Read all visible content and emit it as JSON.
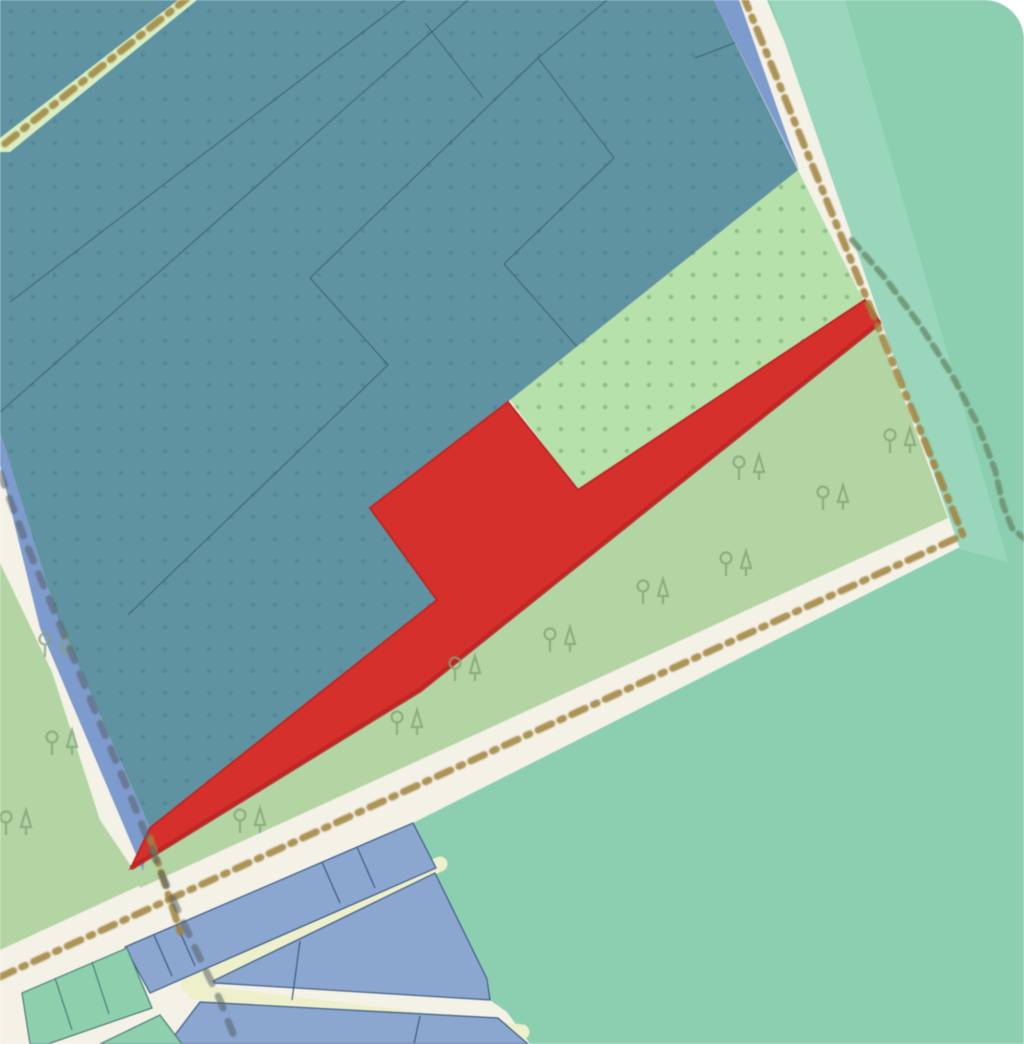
{
  "map": {
    "name": "map-view",
    "canvas": {
      "width": 1024,
      "height": 1044
    },
    "colors": {
      "base_road_cream": "#f4f1e7",
      "pale_yellow_road": "#edf0cb",
      "teal_industrial": "#5f93a2",
      "teal_dot": "#47808f",
      "mint_background": "#8ccfb0",
      "mint_band": "#99d6bc",
      "green_scrub_dotted": "#b6e1ab",
      "green_scrub_dot": "#84b97a",
      "green_wood": "#b3d5a3",
      "path_strip_green": "#daeec2",
      "blue_strip": "#7d9bcc",
      "blue_parcel": "#8ba6cf",
      "blue_parcel_outline": "#3e5a80",
      "mint_parcel": "#8ecfae",
      "mint_parcel_outline": "#497a74",
      "selected_red": "#d6302d",
      "selected_red_edge": "#bd2723",
      "boundary_brown": "#a0823c",
      "boundary_gray": "#555e66",
      "boundary_green": "#6b9170",
      "parcel_line_teal_area": "#2f566b",
      "tree_glyph": "#85a37b",
      "corner_white": "#ffffff"
    },
    "patterns": [
      {
        "id": "teal-dots",
        "size": 22,
        "r": 2.3,
        "color": "#47808f",
        "opacity": 0.55
      },
      {
        "id": "green-dots",
        "size": 22,
        "r": 2.3,
        "color": "#84b97a",
        "opacity": 0.8
      }
    ],
    "regions": [
      {
        "name": "mint-background-area",
        "fill": "#8ccfb0",
        "points": [
          [
            767,
            0
          ],
          [
            1024,
            0
          ],
          [
            1024,
            1044
          ],
          [
            530,
            1044
          ],
          [
            507,
            1012
          ],
          [
            490,
            1000
          ],
          [
            488,
            980
          ],
          [
            432,
            868
          ],
          [
            413,
            823
          ],
          [
            962,
            546
          ],
          [
            985,
            518
          ]
        ]
      },
      {
        "name": "mint-roadside-band",
        "fill": "#99d6bc",
        "points": [
          [
            770,
            0
          ],
          [
            845,
            0
          ],
          [
            1008,
            562
          ],
          [
            960,
            549
          ]
        ]
      },
      {
        "name": "wood-area-left",
        "fill": "#b3d5a3",
        "points": [
          [
            0,
            563
          ],
          [
            52,
            672
          ],
          [
            100,
            820
          ],
          [
            143,
            884
          ],
          [
            0,
            950
          ]
        ]
      },
      {
        "name": "wood-wedge-southeast",
        "fill": "#b3d5a3",
        "points": [
          [
            870,
            308
          ],
          [
            948,
            518
          ],
          [
            140,
            888
          ],
          [
            131,
            868
          ],
          [
            420,
            690
          ],
          [
            880,
            324
          ]
        ]
      },
      {
        "name": "scrub-dotted-wedge",
        "fill": "#b6e1ab",
        "pattern": "green-dots",
        "points": [
          [
            798,
            170
          ],
          [
            863,
            300
          ],
          [
            578,
            490
          ],
          [
            510,
            400
          ]
        ]
      },
      {
        "name": "industrial-teal-area",
        "fill": "#5f93a2",
        "pattern": "teal-dots",
        "points": [
          [
            0,
            0
          ],
          [
            714,
            0
          ],
          [
            798,
            170
          ],
          [
            510,
            400
          ],
          [
            370,
            508
          ],
          [
            437,
            600
          ],
          [
            150,
            828
          ],
          [
            58,
            620
          ],
          [
            0,
            432
          ]
        ]
      },
      {
        "name": "path-strip-topleft",
        "fill": "#daeec2",
        "points": [
          [
            178,
            0
          ],
          [
            197,
            0
          ],
          [
            10,
            152
          ],
          [
            0,
            152
          ],
          [
            0,
            138
          ]
        ]
      },
      {
        "name": "blue-strip-left",
        "fill": "#7d9bcc",
        "points": [
          [
            0,
            432
          ],
          [
            58,
            620
          ],
          [
            150,
            828
          ],
          [
            143,
            871
          ],
          [
            40,
            628
          ],
          [
            0,
            465
          ]
        ]
      },
      {
        "name": "blue-strip-topright",
        "fill": "#7d9bcc",
        "points": [
          [
            714,
            0
          ],
          [
            739,
            0
          ],
          [
            799,
            170
          ]
        ]
      }
    ],
    "selected_parcel": {
      "name": "selected-parcel-red",
      "fill": "#d6302d",
      "stroke": "#bd2723",
      "points": [
        [
          865,
          300
        ],
        [
          578,
          490
        ],
        [
          508,
          402
        ],
        [
          370,
          508
        ],
        [
          437,
          600
        ],
        [
          150,
          828
        ],
        [
          131,
          868
        ],
        [
          420,
          690
        ],
        [
          880,
          322
        ]
      ],
      "dark_edge": [
        [
          131,
          868
        ],
        [
          420,
          690
        ],
        [
          880,
          322
        ]
      ]
    },
    "bottom_roads": [
      {
        "name": "pale-road-parallel",
        "color": "#edf0cb",
        "width": 15,
        "points": [
          [
            188,
            985
          ],
          [
            440,
            864
          ]
        ]
      },
      {
        "name": "pale-road-perpendicular",
        "color": "#edf0cb",
        "width": 15,
        "points": [
          [
            195,
            992
          ],
          [
            522,
            1032
          ]
        ]
      }
    ],
    "parcels": [
      {
        "name": "blue-parcel-row-a",
        "fill": "#8ba6cf",
        "stroke": "#3e5a80",
        "points": [
          [
            125,
            947
          ],
          [
            413,
            823
          ],
          [
            436,
            868
          ],
          [
            150,
            993
          ]
        ]
      },
      {
        "name": "blue-parcel-row-b",
        "fill": "#8ba6cf",
        "stroke": "#3e5a80",
        "points": [
          [
            213,
            981
          ],
          [
            435,
            873
          ],
          [
            487,
            979
          ],
          [
            490,
            1000
          ],
          [
            215,
            983
          ]
        ]
      },
      {
        "name": "blue-parcel-row-c",
        "fill": "#8ba6cf",
        "stroke": "#3e5a80",
        "points": [
          [
            200,
            1002
          ],
          [
            498,
            1018
          ],
          [
            528,
            1044
          ],
          [
            168,
            1044
          ]
        ]
      },
      {
        "name": "mint-parcel-strip",
        "fill": "#8ecfae",
        "stroke": "#497a74",
        "points": [
          [
            22,
            993
          ],
          [
            127,
            948
          ],
          [
            152,
            1008
          ],
          [
            48,
            1044
          ],
          [
            30,
            1044
          ]
        ]
      },
      {
        "name": "mint-parcel-corner",
        "fill": "#8ecfae",
        "stroke": "#497a74",
        "points": [
          [
            100,
            1044
          ],
          [
            160,
            1015
          ],
          [
            182,
            1044
          ]
        ]
      }
    ],
    "parcel_division_lines": [
      {
        "color": "#3e5a80",
        "points": [
          [
            154,
            935
          ],
          [
            172,
            976
          ]
        ]
      },
      {
        "color": "#3e5a80",
        "points": [
          [
            177,
            925
          ],
          [
            195,
            966
          ]
        ]
      },
      {
        "color": "#3e5a80",
        "points": [
          [
            322,
            862
          ],
          [
            340,
            903
          ]
        ]
      },
      {
        "color": "#3e5a80",
        "points": [
          [
            357,
            847
          ],
          [
            375,
            888
          ]
        ]
      },
      {
        "color": "#3e5a80",
        "points": [
          [
            300,
            941
          ],
          [
            292,
            1000
          ]
        ]
      },
      {
        "color": "#3e5a80",
        "points": [
          [
            420,
            1016
          ],
          [
            414,
            1044
          ]
        ]
      },
      {
        "color": "#497a74",
        "points": [
          [
            55,
            978
          ],
          [
            72,
            1030
          ]
        ]
      },
      {
        "color": "#497a74",
        "points": [
          [
            92,
            962
          ],
          [
            109,
            1014
          ]
        ]
      }
    ],
    "teal_parcel_lines": [
      [
        [
          405,
          0
        ],
        [
          10,
          302
        ]
      ],
      [
        [
          468,
          0
        ],
        [
          0,
          412
        ]
      ],
      [
        [
          607,
          0
        ],
        [
          538,
          58
        ]
      ],
      [
        [
          538,
          58
        ],
        [
          310,
          278
        ]
      ],
      [
        [
          310,
          278
        ],
        [
          388,
          365
        ]
      ],
      [
        [
          388,
          365
        ],
        [
          128,
          615
        ]
      ],
      [
        [
          538,
          58
        ],
        [
          614,
          158
        ]
      ],
      [
        [
          614,
          158
        ],
        [
          504,
          264
        ]
      ],
      [
        [
          504,
          264
        ],
        [
          580,
          350
        ]
      ],
      [
        [
          425,
          23
        ],
        [
          483,
          98
        ]
      ],
      [
        [
          695,
          58
        ],
        [
          758,
          34
        ]
      ]
    ],
    "boundaries": [
      {
        "name": "boundary-brown-main",
        "color": "#a0823c",
        "width": 7,
        "dash": "15 9 4 9",
        "opacity": 0.85,
        "points": [
          [
            0,
            977
          ],
          [
            963,
            535
          ],
          [
            745,
            0
          ]
        ]
      },
      {
        "name": "boundary-brown-path-topleft",
        "color": "#a0823c",
        "width": 7,
        "dash": "15 9 4 9",
        "opacity": 0.85,
        "points": [
          [
            190,
            -4
          ],
          [
            2,
            146
          ]
        ]
      },
      {
        "name": "boundary-brown-junction-stub",
        "color": "#a0823c",
        "width": 7,
        "dash": "14 9 4 9",
        "opacity": 0.85,
        "points": [
          [
            150,
            838
          ],
          [
            181,
            934
          ]
        ]
      },
      {
        "name": "boundary-gray-dashed",
        "color": "#555e66",
        "width": 7,
        "dash": "13 14",
        "opacity": 0.55,
        "points": [
          [
            0,
            473
          ],
          [
            28,
            548
          ],
          [
            62,
            630
          ],
          [
            98,
            718
          ],
          [
            132,
            800
          ],
          [
            162,
            875
          ],
          [
            195,
            948
          ],
          [
            220,
            1000
          ],
          [
            237,
            1044
          ]
        ]
      },
      {
        "name": "path-green-dashed",
        "color": "#6b9170",
        "width": 6,
        "dash": "11 8",
        "opacity": 0.85,
        "points": [
          [
            852,
            240
          ],
          [
            885,
            278
          ],
          [
            920,
            325
          ],
          [
            952,
            375
          ],
          [
            978,
            425
          ],
          [
            995,
            470
          ],
          [
            1003,
            505
          ],
          [
            1012,
            528
          ],
          [
            1026,
            540
          ]
        ]
      }
    ],
    "trees": [
      [
        55,
        648
      ],
      [
        62,
        746
      ],
      [
        16,
        826
      ],
      [
        250,
        824
      ],
      [
        465,
        672
      ],
      [
        407,
        726
      ],
      [
        560,
        643
      ],
      [
        653,
        595
      ],
      [
        736,
        567
      ],
      [
        749,
        471
      ],
      [
        833,
        501
      ],
      [
        900,
        444
      ]
    ],
    "corner_round": {
      "name": "rounded-corner-topright",
      "radius": 40,
      "fill": "#ffffff"
    }
  }
}
